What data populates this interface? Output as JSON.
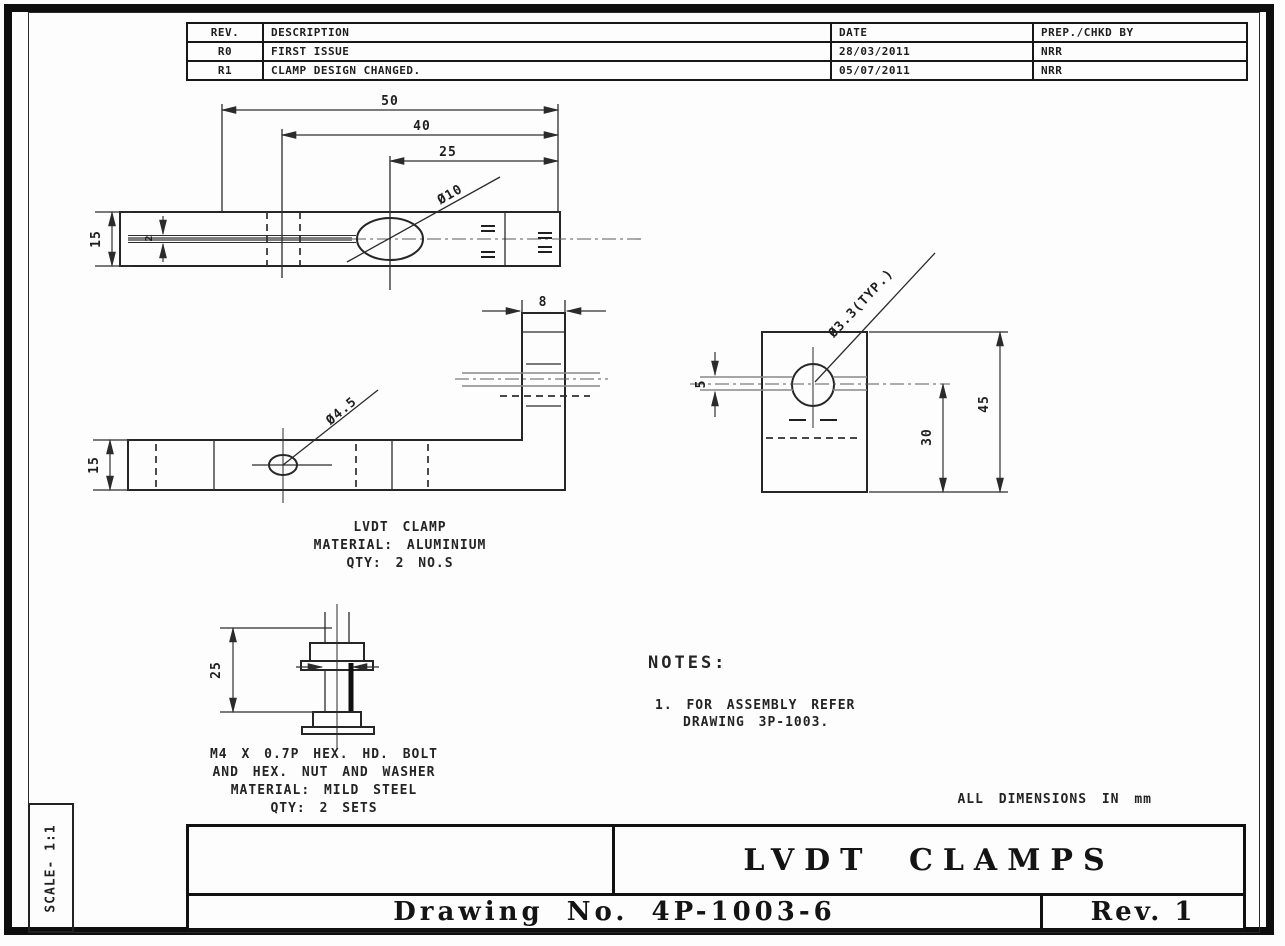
{
  "sheet": {
    "scale_label": "SCALE- 1:1",
    "dimensions_note": "ALL DIMENSIONS IN mm"
  },
  "revision_table": {
    "headers": {
      "rev": "REV.",
      "description": "DESCRIPTION",
      "date": "DATE",
      "prep": "PREP./CHKD BY"
    },
    "rows": [
      {
        "rev": "R0",
        "description": "FIRST ISSUE",
        "date": "28/03/2011",
        "prep": "NRR"
      },
      {
        "rev": "R1",
        "description": "CLAMP DESIGN CHANGED.",
        "date": "05/07/2011",
        "prep": "NRR"
      }
    ]
  },
  "views": {
    "top_view": {
      "dims": {
        "d50": "50",
        "d40": "40",
        "d25": "25",
        "d15": "15",
        "d2": "2",
        "hole": "Ø10"
      }
    },
    "front_view": {
      "dims": {
        "d15": "15",
        "d8": "8",
        "hole": "Ø4.5"
      }
    },
    "side_view": {
      "dims": {
        "d5": "5",
        "d30": "30",
        "d45": "45",
        "hole": "Ø3.3(TYP.)"
      }
    },
    "bolt_view": {
      "dims": {
        "d25": "25"
      }
    }
  },
  "labels": {
    "clamp": [
      "LVDT CLAMP",
      "MATERIAL: ALUMINIUM",
      "QTY: 2 NO.S"
    ],
    "bolt": [
      "M4 X 0.7P HEX. HD. BOLT",
      "AND HEX. NUT AND WASHER",
      "MATERIAL: MILD STEEL",
      "QTY: 2 SETS"
    ]
  },
  "notes": {
    "title": "NOTES:",
    "items": [
      {
        "line1": "1. FOR ASSEMBLY REFER",
        "line2": "DRAWING 3P-1003."
      }
    ]
  },
  "title_block": {
    "title": "LVDT CLAMPS",
    "drawing_no": "Drawing No. 4P-1003-6",
    "rev": "Rev. 1"
  },
  "colors": {
    "ink": "#1d1d1d",
    "slot_gray": "#7e7e7e"
  }
}
